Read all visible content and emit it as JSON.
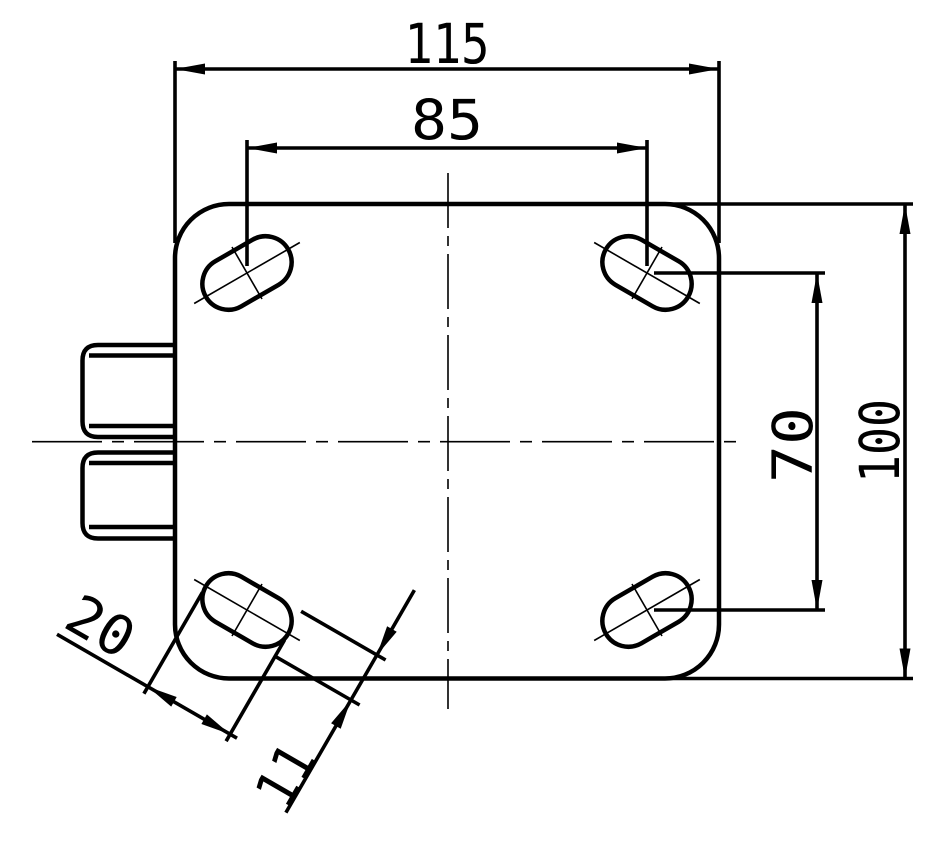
{
  "drawing": {
    "type": "technical-dimension-drawing",
    "background": "#ffffff",
    "line_color": "#000000",
    "dims": {
      "plate_width": "115",
      "hole_spacing_h": "85",
      "hole_spacing_v": "70",
      "plate_height": "100",
      "slot_length": "20",
      "slot_width": "11"
    }
  }
}
